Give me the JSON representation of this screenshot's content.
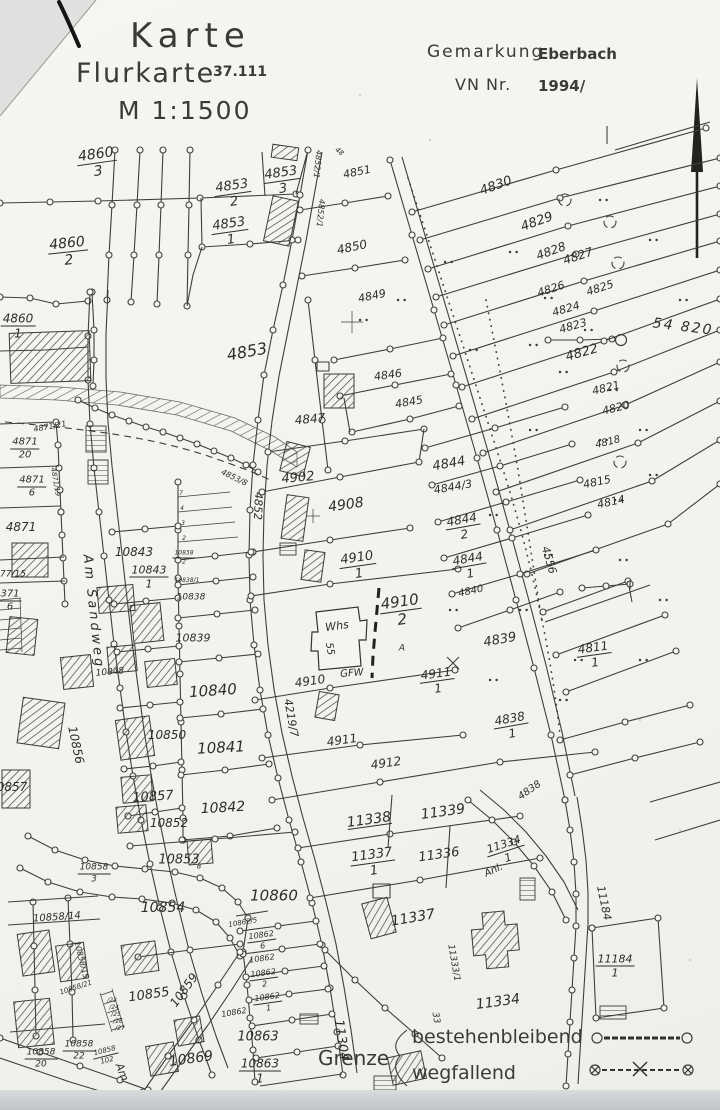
{
  "document": {
    "type_label": "Karte",
    "map_type": "Flurkarte",
    "sheet_number": "37.111",
    "scale": "M 1:1500",
    "gemarkung_label": "Gemarkung",
    "gemarkung_value": "Eberbach",
    "vn_label": "VN Nr.",
    "vn_value": "1994/"
  },
  "legend": {
    "grenze_label": "Grenze",
    "items": [
      {
        "label": "bestehenbleibend",
        "symbol": "line-with-open-circles"
      },
      {
        "label": "wegfallend",
        "symbol": "dashed-line-crossed-circles-x"
      }
    ]
  },
  "colors": {
    "paper": "#f4f3f0",
    "line": "#3f3e3c",
    "ink": "#2e2d2b"
  },
  "map": {
    "grid_coordinate": "54 820",
    "labels": [
      {
        "t": "4860",
        "d": "3",
        "x": 97,
        "y": 163,
        "s": 14,
        "r": -8
      },
      {
        "t": "4853",
        "d": "2",
        "x": 233,
        "y": 194,
        "s": 13,
        "r": -8
      },
      {
        "t": "4853",
        "d": "3",
        "x": 282,
        "y": 181,
        "s": 13,
        "r": -8
      },
      {
        "t": "4853",
        "d": "1",
        "x": 230,
        "y": 232,
        "s": 13,
        "r": -8
      },
      {
        "t": "4860",
        "d": "2",
        "x": 68,
        "y": 252,
        "s": 14,
        "r": -6
      },
      {
        "t": "4860",
        "d": "1",
        "x": 18,
        "y": 326,
        "s": 12
      },
      {
        "t": "4851",
        "x": 357,
        "y": 172,
        "s": 11,
        "r": -12
      },
      {
        "t": "4850",
        "x": 352,
        "y": 247,
        "s": 12,
        "r": -12
      },
      {
        "t": "4849",
        "x": 372,
        "y": 296,
        "s": 11,
        "r": -12
      },
      {
        "t": "4853",
        "x": 247,
        "y": 352,
        "s": 16,
        "r": -10
      },
      {
        "t": "4852/1",
        "x": 317,
        "y": 164,
        "s": 8,
        "r": 96
      },
      {
        "t": "4852/1",
        "x": 320,
        "y": 213,
        "s": 8,
        "r": 96
      },
      {
        "t": "48",
        "x": 339,
        "y": 152,
        "s": 7,
        "r": 40
      },
      {
        "t": "4830",
        "x": 496,
        "y": 186,
        "s": 13,
        "r": -20
      },
      {
        "t": "4829",
        "x": 537,
        "y": 222,
        "s": 13,
        "r": -20
      },
      {
        "t": "4828",
        "x": 551,
        "y": 251,
        "s": 12,
        "r": -20
      },
      {
        "t": "4827",
        "x": 578,
        "y": 256,
        "s": 12,
        "r": -18
      },
      {
        "t": "4826",
        "x": 551,
        "y": 289,
        "s": 11,
        "r": -18
      },
      {
        "t": "4825",
        "x": 600,
        "y": 288,
        "s": 11,
        "r": -18
      },
      {
        "t": "4824",
        "x": 566,
        "y": 309,
        "s": 11,
        "r": -16
      },
      {
        "t": "4823",
        "x": 573,
        "y": 326,
        "s": 11,
        "r": -16
      },
      {
        "t": "4822",
        "x": 582,
        "y": 353,
        "s": 13,
        "r": -16
      },
      {
        "t": "4821",
        "x": 606,
        "y": 388,
        "s": 11,
        "r": -14
      },
      {
        "t": "4820",
        "x": 616,
        "y": 408,
        "s": 11,
        "r": -14
      },
      {
        "t": "4818",
        "x": 608,
        "y": 443,
        "s": 10,
        "r": -14
      },
      {
        "t": "4815",
        "x": 597,
        "y": 482,
        "s": 11,
        "r": -12
      },
      {
        "t": "4814",
        "x": 611,
        "y": 502,
        "s": 11,
        "r": -12
      },
      {
        "t": "54 820",
        "x": 683,
        "y": 327,
        "s": 14,
        "r": 7,
        "ls": 2,
        "n": "grid-coordinate-label"
      },
      {
        "t": "4846",
        "x": 388,
        "y": 375,
        "s": 11,
        "r": -8
      },
      {
        "t": "4845",
        "x": 409,
        "y": 402,
        "s": 11,
        "r": -10
      },
      {
        "t": "4847",
        "x": 310,
        "y": 419,
        "s": 12,
        "r": -5
      },
      {
        "t": "4902",
        "x": 298,
        "y": 478,
        "s": 13,
        "r": -5
      },
      {
        "t": "4908",
        "x": 346,
        "y": 505,
        "s": 14,
        "r": -8
      },
      {
        "t": "4844",
        "x": 449,
        "y": 464,
        "s": 13,
        "r": -10
      },
      {
        "t": "4844/3",
        "x": 453,
        "y": 487,
        "s": 11,
        "r": -10
      },
      {
        "t": "4844",
        "d": "2",
        "x": 463,
        "y": 527,
        "s": 12,
        "r": -10
      },
      {
        "t": "4844",
        "d": "1",
        "x": 469,
        "y": 566,
        "s": 12,
        "r": -10
      },
      {
        "t": "4840",
        "x": 471,
        "y": 592,
        "s": 10,
        "r": -12
      },
      {
        "t": "4839",
        "x": 500,
        "y": 640,
        "s": 13,
        "r": -10
      },
      {
        "t": "4910",
        "d": "1",
        "x": 358,
        "y": 566,
        "s": 13,
        "r": -8
      },
      {
        "t": "4910",
        "d": "2",
        "x": 401,
        "y": 611,
        "s": 15,
        "r": -8
      },
      {
        "t": "A",
        "x": 402,
        "y": 649,
        "s": 9
      },
      {
        "t": "Whs",
        "x": 337,
        "y": 626,
        "s": 11,
        "r": -8,
        "n": "building-label"
      },
      {
        "t": "55",
        "x": 329,
        "y": 649,
        "s": 10,
        "r": 80,
        "n": "house-number-label"
      },
      {
        "t": "GFW",
        "x": 352,
        "y": 674,
        "s": 10,
        "r": -5,
        "n": "building-label"
      },
      {
        "t": "4910",
        "x": 310,
        "y": 681,
        "s": 12,
        "r": -8
      },
      {
        "t": "4911",
        "d": "1",
        "x": 437,
        "y": 681,
        "s": 12,
        "r": -8
      },
      {
        "t": "4911",
        "x": 342,
        "y": 740,
        "s": 12,
        "r": -8
      },
      {
        "t": "4912",
        "x": 386,
        "y": 763,
        "s": 12,
        "r": -8
      },
      {
        "t": "4556",
        "x": 549,
        "y": 560,
        "s": 11,
        "r": 74,
        "n": "street-number-label"
      },
      {
        "t": "4219/7",
        "x": 291,
        "y": 718,
        "s": 11,
        "r": 80,
        "n": "street-number-label"
      },
      {
        "t": "4811",
        "d": "1",
        "x": 594,
        "y": 655,
        "s": 12,
        "r": -8
      },
      {
        "t": "4838",
        "d": "1",
        "x": 511,
        "y": 726,
        "s": 12,
        "r": -10
      },
      {
        "t": "4838",
        "x": 530,
        "y": 791,
        "s": 10,
        "r": -35
      },
      {
        "t": "4871",
        "d": "20",
        "x": 25,
        "y": 449,
        "s": 10
      },
      {
        "t": "4871/21",
        "x": 50,
        "y": 427,
        "s": 8,
        "r": -10
      },
      {
        "t": "4871/19",
        "x": 55,
        "y": 482,
        "s": 7,
        "r": 80
      },
      {
        "t": "4871",
        "d": "6",
        "x": 32,
        "y": 487,
        "s": 10
      },
      {
        "t": "4871",
        "x": 21,
        "y": 527,
        "s": 12
      },
      {
        "t": "77/15",
        "x": 13,
        "y": 575,
        "s": 9
      },
      {
        "t": "371",
        "d": "6",
        "x": 10,
        "y": 601,
        "s": 10
      },
      {
        "t": "4853/8",
        "x": 234,
        "y": 478,
        "s": 8,
        "r": 26
      },
      {
        "t": "4852",
        "x": 258,
        "y": 506,
        "s": 11,
        "r": 92,
        "n": "street-number-label"
      },
      {
        "t": "10843",
        "x": 134,
        "y": 552,
        "s": 12
      },
      {
        "t": "10843",
        "d": "1",
        "x": 149,
        "y": 577,
        "s": 11
      },
      {
        "t": "7",
        "x": 181,
        "y": 494,
        "s": 6
      },
      {
        "t": "4",
        "x": 182,
        "y": 509,
        "s": 6
      },
      {
        "t": "3",
        "x": 183,
        "y": 524,
        "s": 6
      },
      {
        "t": "2",
        "x": 184,
        "y": 539,
        "s": 6
      },
      {
        "t": "10838",
        "d": "2",
        "x": 184,
        "y": 558,
        "s": 6
      },
      {
        "t": "10838/1",
        "x": 187,
        "y": 581,
        "s": 6
      },
      {
        "t": "10838",
        "x": 191,
        "y": 598,
        "s": 9
      },
      {
        "t": "10839",
        "x": 193,
        "y": 638,
        "s": 11
      },
      {
        "t": "10848",
        "x": 110,
        "y": 673,
        "s": 9,
        "r": -5
      },
      {
        "t": "10840",
        "x": 213,
        "y": 691,
        "s": 15,
        "r": -4
      },
      {
        "t": "10850",
        "x": 167,
        "y": 735,
        "s": 12
      },
      {
        "t": "10841",
        "x": 221,
        "y": 748,
        "s": 15,
        "r": -3
      },
      {
        "t": "10856",
        "x": 76,
        "y": 745,
        "s": 12,
        "r": 78,
        "n": "street-number-label"
      },
      {
        "t": "10857",
        "x": 153,
        "y": 797,
        "s": 13,
        "r": -4
      },
      {
        "t": "0857",
        "x": 12,
        "y": 787,
        "s": 12
      },
      {
        "t": "10842",
        "x": 223,
        "y": 808,
        "s": 14,
        "r": -3
      },
      {
        "t": "10852",
        "x": 169,
        "y": 823,
        "s": 12
      },
      {
        "t": "10853",
        "x": 179,
        "y": 860,
        "s": 13
      },
      {
        "t": "8",
        "x": 199,
        "y": 867,
        "s": 7
      },
      {
        "t": "10858",
        "d": "3",
        "x": 94,
        "y": 874,
        "s": 9
      },
      {
        "t": "10858/14",
        "x": 57,
        "y": 918,
        "s": 10,
        "r": -4
      },
      {
        "t": "10858/15",
        "x": 81,
        "y": 960,
        "s": 8,
        "r": 76
      },
      {
        "t": "10858/21",
        "x": 76,
        "y": 988,
        "s": 7,
        "r": -18
      },
      {
        "t": "/23",
        "x": 112,
        "y": 1001,
        "s": 6
      },
      {
        "t": "/24",
        "x": 114,
        "y": 1008,
        "s": 6
      },
      {
        "t": "/25",
        "x": 116,
        "y": 1015,
        "s": 6
      },
      {
        "t": "/26",
        "x": 118,
        "y": 1022,
        "s": 6
      },
      {
        "t": "/27",
        "x": 120,
        "y": 1029,
        "s": 6
      },
      {
        "t": "10854",
        "x": 163,
        "y": 908,
        "s": 14
      },
      {
        "t": "10855",
        "x": 149,
        "y": 995,
        "s": 13,
        "r": -8
      },
      {
        "t": "10859",
        "x": 184,
        "y": 990,
        "s": 12,
        "r": -54,
        "n": "street-number-label"
      },
      {
        "t": "10858",
        "d": "22",
        "x": 79,
        "y": 1051,
        "s": 9
      },
      {
        "t": "10858",
        "d": "20",
        "x": 41,
        "y": 1059,
        "s": 9
      },
      {
        "t": "10858",
        "d": "102",
        "x": 106,
        "y": 1056,
        "s": 7,
        "r": -14
      },
      {
        "t": "10860",
        "x": 274,
        "y": 896,
        "s": 15
      },
      {
        "t": "10862/5",
        "x": 243,
        "y": 923,
        "s": 7,
        "r": -10
      },
      {
        "t": "10862",
        "d": "6",
        "x": 262,
        "y": 941,
        "s": 8,
        "r": -8
      },
      {
        "t": "10862",
        "x": 262,
        "y": 959,
        "s": 8,
        "r": -8
      },
      {
        "t": "10862",
        "d": "2",
        "x": 264,
        "y": 979,
        "s": 8,
        "r": -8
      },
      {
        "t": "10862",
        "d": "1",
        "x": 268,
        "y": 1003,
        "s": 8,
        "r": -8
      },
      {
        "t": "10862",
        "x": 234,
        "y": 1013,
        "s": 8,
        "r": -10
      },
      {
        "t": "10869",
        "x": 191,
        "y": 1059,
        "s": 14,
        "r": -8
      },
      {
        "t": "10863",
        "x": 258,
        "y": 1037,
        "s": 13
      },
      {
        "t": "10863",
        "d": "1",
        "x": 260,
        "y": 1071,
        "s": 12
      },
      {
        "t": "11304",
        "x": 341,
        "y": 1040,
        "s": 13,
        "r": 82,
        "n": "street-number-label"
      },
      {
        "t": "11338",
        "x": 369,
        "y": 820,
        "s": 14,
        "r": -8,
        "u": true
      },
      {
        "t": "11339",
        "x": 443,
        "y": 812,
        "s": 14,
        "r": -8
      },
      {
        "t": "11337",
        "d": "1",
        "x": 373,
        "y": 863,
        "s": 13,
        "r": -8
      },
      {
        "t": "11336",
        "x": 439,
        "y": 855,
        "s": 13,
        "r": -8
      },
      {
        "t": "11337",
        "x": 413,
        "y": 918,
        "s": 14,
        "r": -10
      },
      {
        "t": "11333/1",
        "x": 453,
        "y": 963,
        "s": 9,
        "r": 80
      },
      {
        "t": "33",
        "x": 435,
        "y": 1018,
        "s": 9,
        "r": 80
      },
      {
        "t": "11334",
        "x": 498,
        "y": 1002,
        "s": 14,
        "r": -8
      },
      {
        "t": "11334",
        "d": "1",
        "x": 506,
        "y": 851,
        "s": 11,
        "r": -18
      },
      {
        "t": "Anl.",
        "x": 494,
        "y": 871,
        "s": 10,
        "r": -25
      },
      {
        "t": "11184",
        "x": 604,
        "y": 903,
        "s": 11,
        "r": 78,
        "n": "street-number-label"
      },
      {
        "t": "11184",
        "d": "1",
        "x": 615,
        "y": 966,
        "s": 11
      },
      {
        "t": "Am Sandweg",
        "x": 93,
        "y": 612,
        "s": 13,
        "r": 84,
        "ls": 3,
        "n": "street-name-label"
      },
      {
        "t": "Am",
        "x": 122,
        "y": 1072,
        "s": 11,
        "r": 68,
        "n": "street-name-label"
      }
    ]
  }
}
